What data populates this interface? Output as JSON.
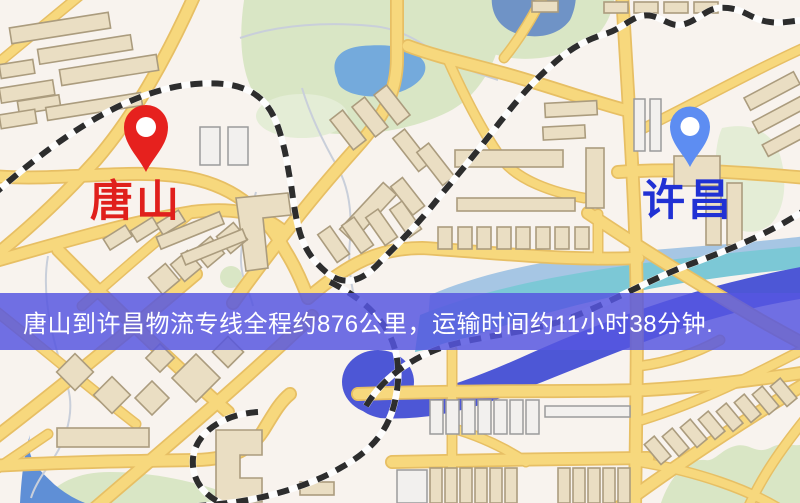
{
  "markers": {
    "origin": {
      "label": "唐山",
      "pin_color": "#e6211e",
      "label_color": "#e0201c"
    },
    "destination": {
      "label": "许昌",
      "pin_color": "#5d8df2",
      "label_color": "#2031d4"
    }
  },
  "banner": {
    "text": "唐山到许昌物流专线全程约876公里，运输时间约11小时38分钟.",
    "background": "rgba(86,86,224,0.84)",
    "text_color": "#ffffff"
  },
  "route_facts": {
    "distance_km": "876",
    "transit_time": "11小时38分钟"
  },
  "map_palette": {
    "background": "#f8f3ee",
    "road": "#f7d87d",
    "road_casing": "#e7bf64",
    "building": "#eadec3",
    "building_gray": "#f2f0ee",
    "park": "#d9e6c5",
    "pond": "#74aadc",
    "river": "#4d57d6",
    "river_teal": "#7cc8d6",
    "railway_dash": "#2d2d2d"
  }
}
